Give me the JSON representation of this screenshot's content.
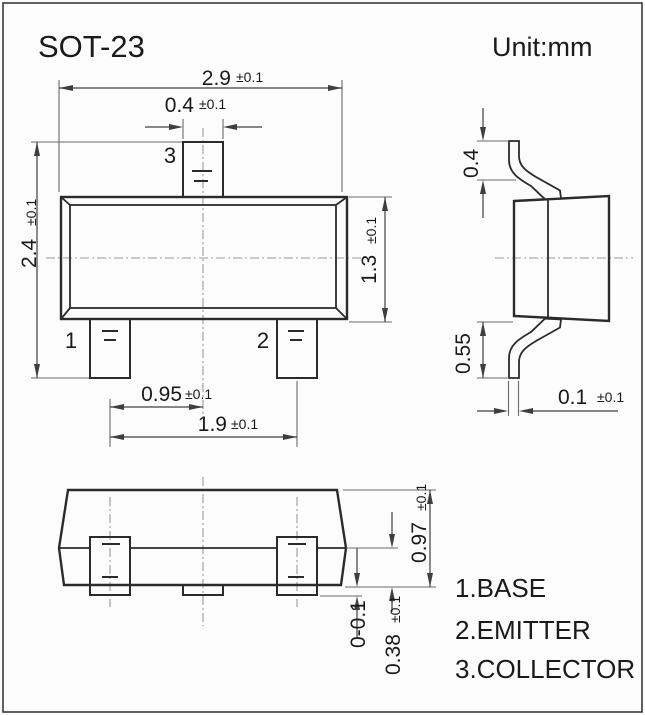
{
  "title": "SOT-23",
  "unit_label": "Unit:mm",
  "pin_labels": {
    "pin1": "1",
    "pin2": "2",
    "pin3": "3"
  },
  "legend": {
    "line1": "1.BASE",
    "line2": "2.EMITTER",
    "line3": "3.COLLECTOR"
  },
  "dims": {
    "body_width": {
      "value": "2.9",
      "tol": "±0.1"
    },
    "lead_width": {
      "value": "0.4",
      "tol": "±0.1"
    },
    "overall_height": {
      "value": "2.4",
      "tol": "±0.1"
    },
    "body_height": {
      "value": "1.3",
      "tol": "±0.1"
    },
    "pin_pitch": {
      "value": "0.95",
      "tol": "±0.1"
    },
    "pin_span": {
      "value": "1.9",
      "tol": "±0.1"
    },
    "lead_top": {
      "value": "0.4"
    },
    "lead_foot": {
      "value": "0.55"
    },
    "lead_thickness": {
      "value": "0.1",
      "tol": "±0.1"
    },
    "body_standoff": {
      "value": "0.97",
      "tol": "±0.1"
    },
    "foot_protrusion": {
      "value": "0-0.1"
    },
    "shoulder": {
      "value": "0.38",
      "tol": "±0.1"
    }
  },
  "colors": {
    "bg": "#fcfcfc",
    "line": "#2b2b2b",
    "dim": "#3f3f3f",
    "ext": "#6a6a6a",
    "center": "#9a9a9a",
    "text": "#1a1a1a"
  }
}
